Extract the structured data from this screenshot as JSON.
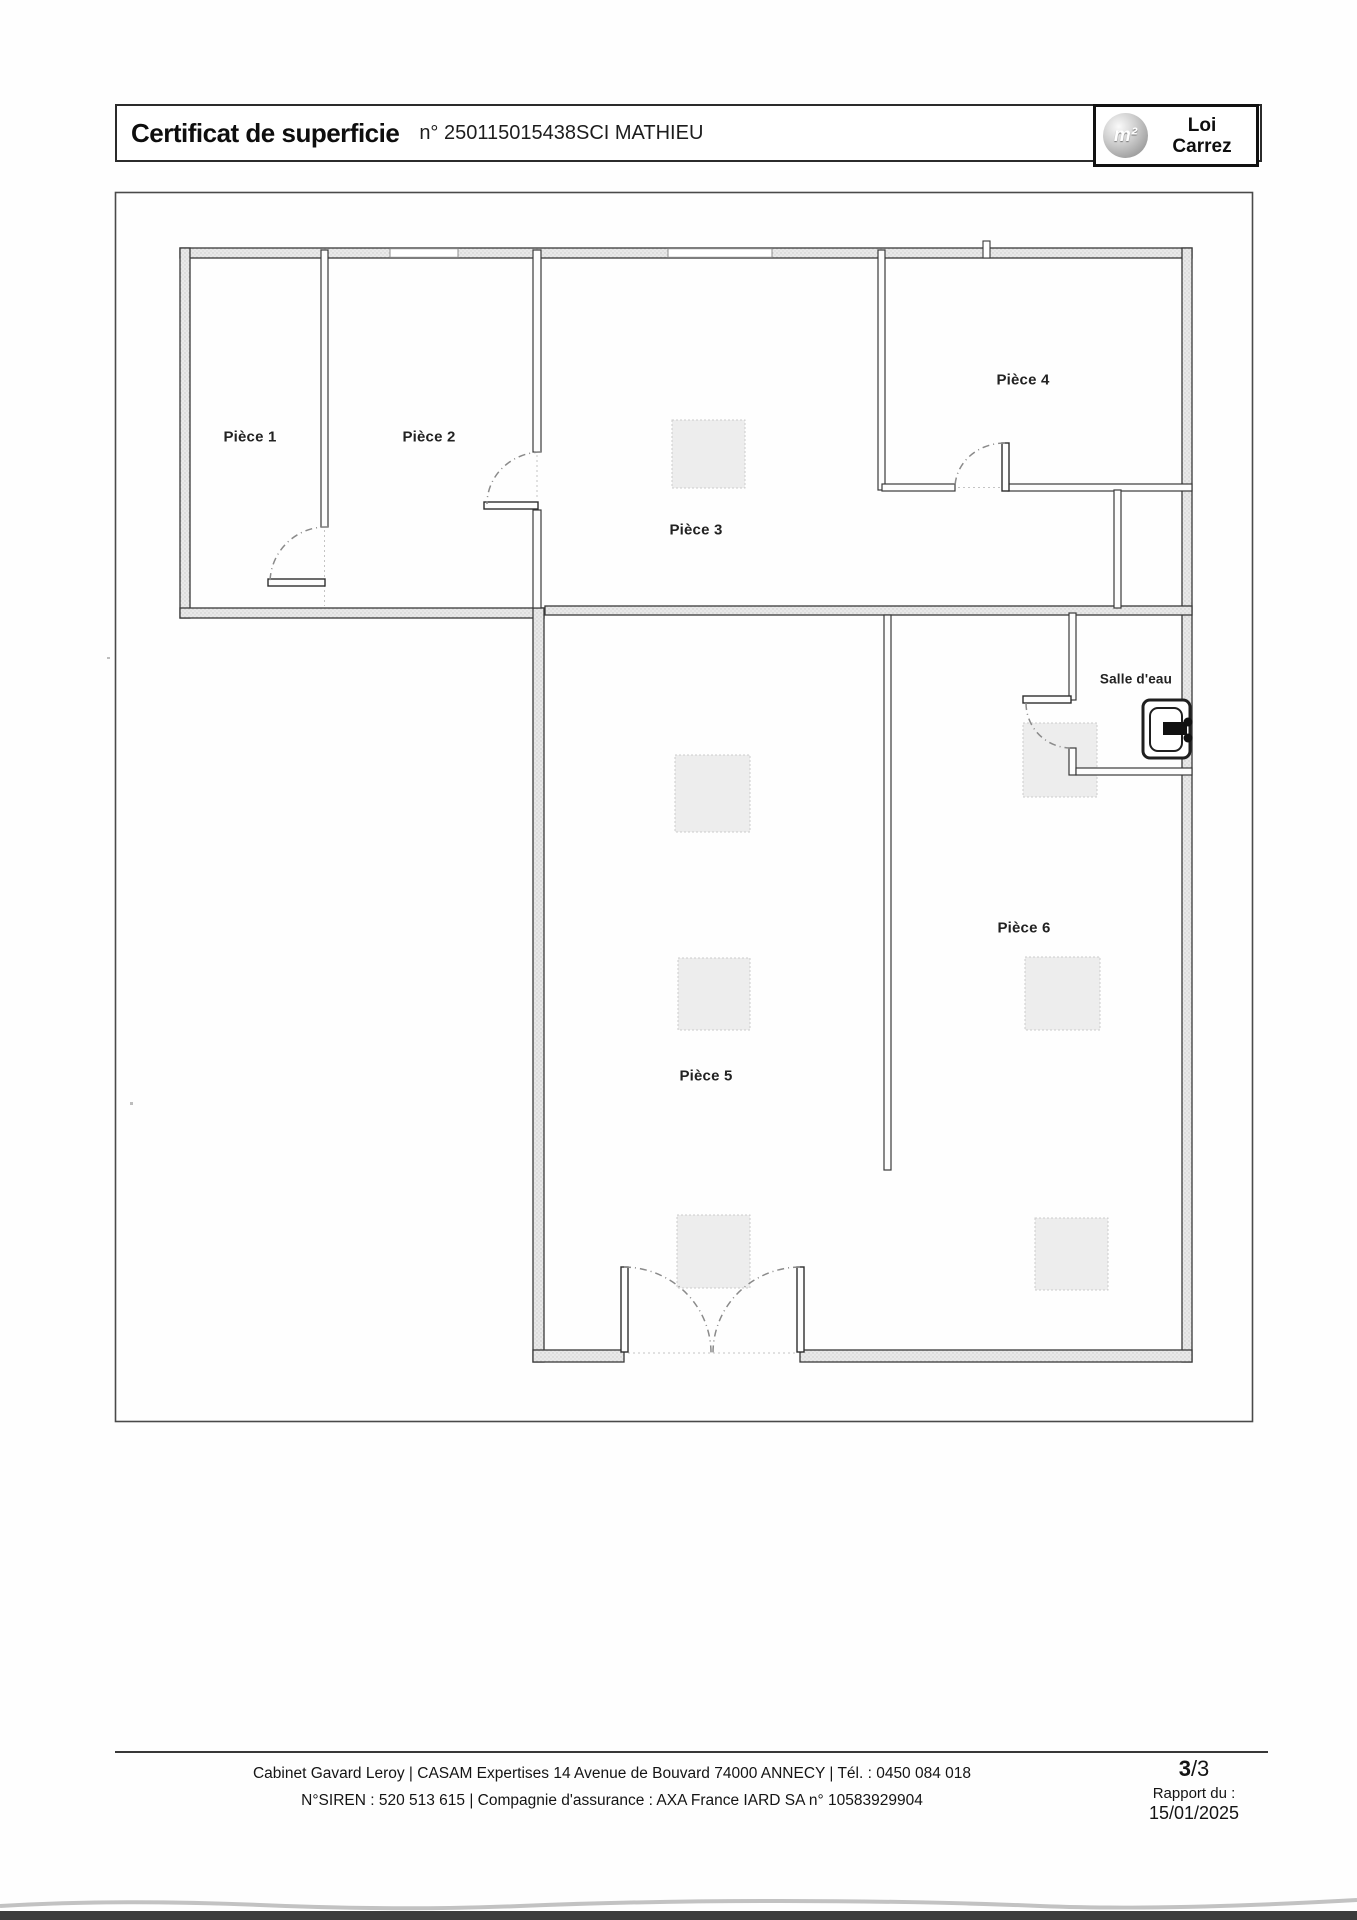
{
  "header": {
    "title": "Certificat de superficie",
    "cert_no": "n° 250115015438SCI MATHIEU",
    "logo_symbol": "m²",
    "logo_line1": "Loi",
    "logo_line2": "Carrez"
  },
  "rooms": {
    "p1": "Pièce 1",
    "p2": "Pièce 2",
    "p3": "Pièce 3",
    "p4": "Pièce 4",
    "p5": "Pièce 5",
    "p6": "Pièce 6",
    "salle_eau": "Salle d'eau"
  },
  "footer": {
    "line1": "Cabinet Gavard Leroy | CASAM Expertises 14 Avenue de Bouvard 74000 ANNECY | Tél. : 0450 084 018",
    "line2": "N°SIREN : 520 513 615 | Compagnie d'assurance : AXA France IARD SA n° 10583929904",
    "page_current": "3",
    "page_rest": "/3",
    "report_label": "Rapport du :",
    "report_date": "15/01/2025"
  },
  "colors": {
    "ink": "#1a1a1a",
    "wall_outline": "#3a3a3a",
    "wall_fill": "#e8e8e8"
  }
}
